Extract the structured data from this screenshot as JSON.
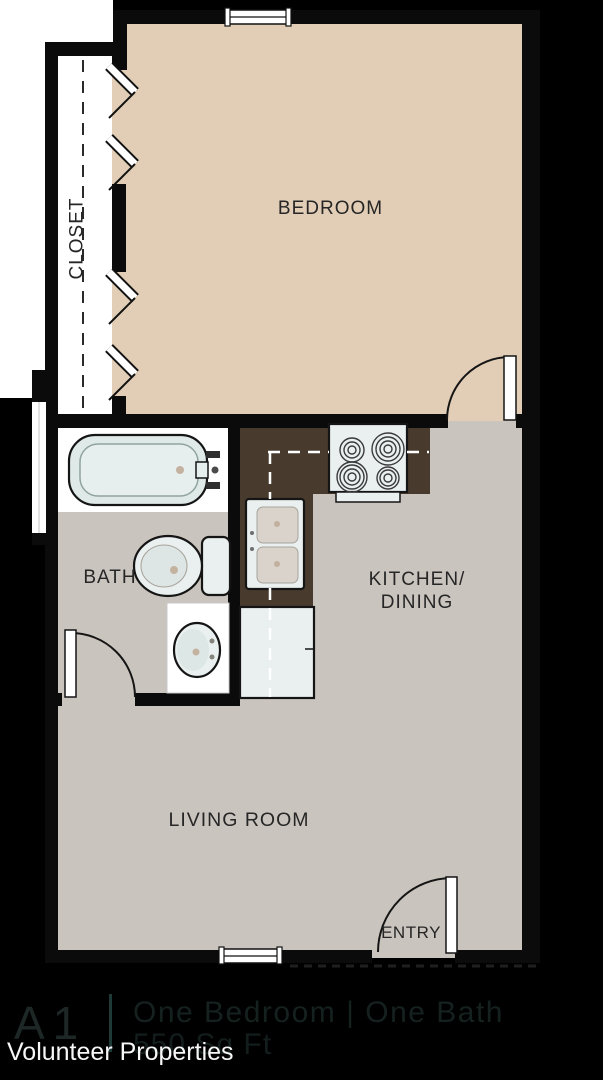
{
  "theme": {
    "wall": "#0b0b0b",
    "tan": "#e2ceb6",
    "floor": "#cac4be",
    "counter": "#483a2c",
    "fixture": "#e9f0ef",
    "basin": "#d9d3cc",
    "white": "#ffffff",
    "label": "#262626",
    "footerUnit": "#1d2725",
    "footerDivider": "#1e3a37",
    "footerTitle": "#15211f",
    "footerArea": "#131d1c",
    "company": "#f7f7f7"
  },
  "rooms": {
    "bedroom": "BEDROOM",
    "closet": "CLOSET",
    "bath": "BATH",
    "kitchen_line1": "KITCHEN/",
    "kitchen_line2": "DINING",
    "living": "LIVING ROOM",
    "entry": "ENTRY"
  },
  "footer": {
    "unit": "A1",
    "title": "One Bedroom | One Bath",
    "area": "550 Sq Ft",
    "company": "Volunteer Properties"
  }
}
